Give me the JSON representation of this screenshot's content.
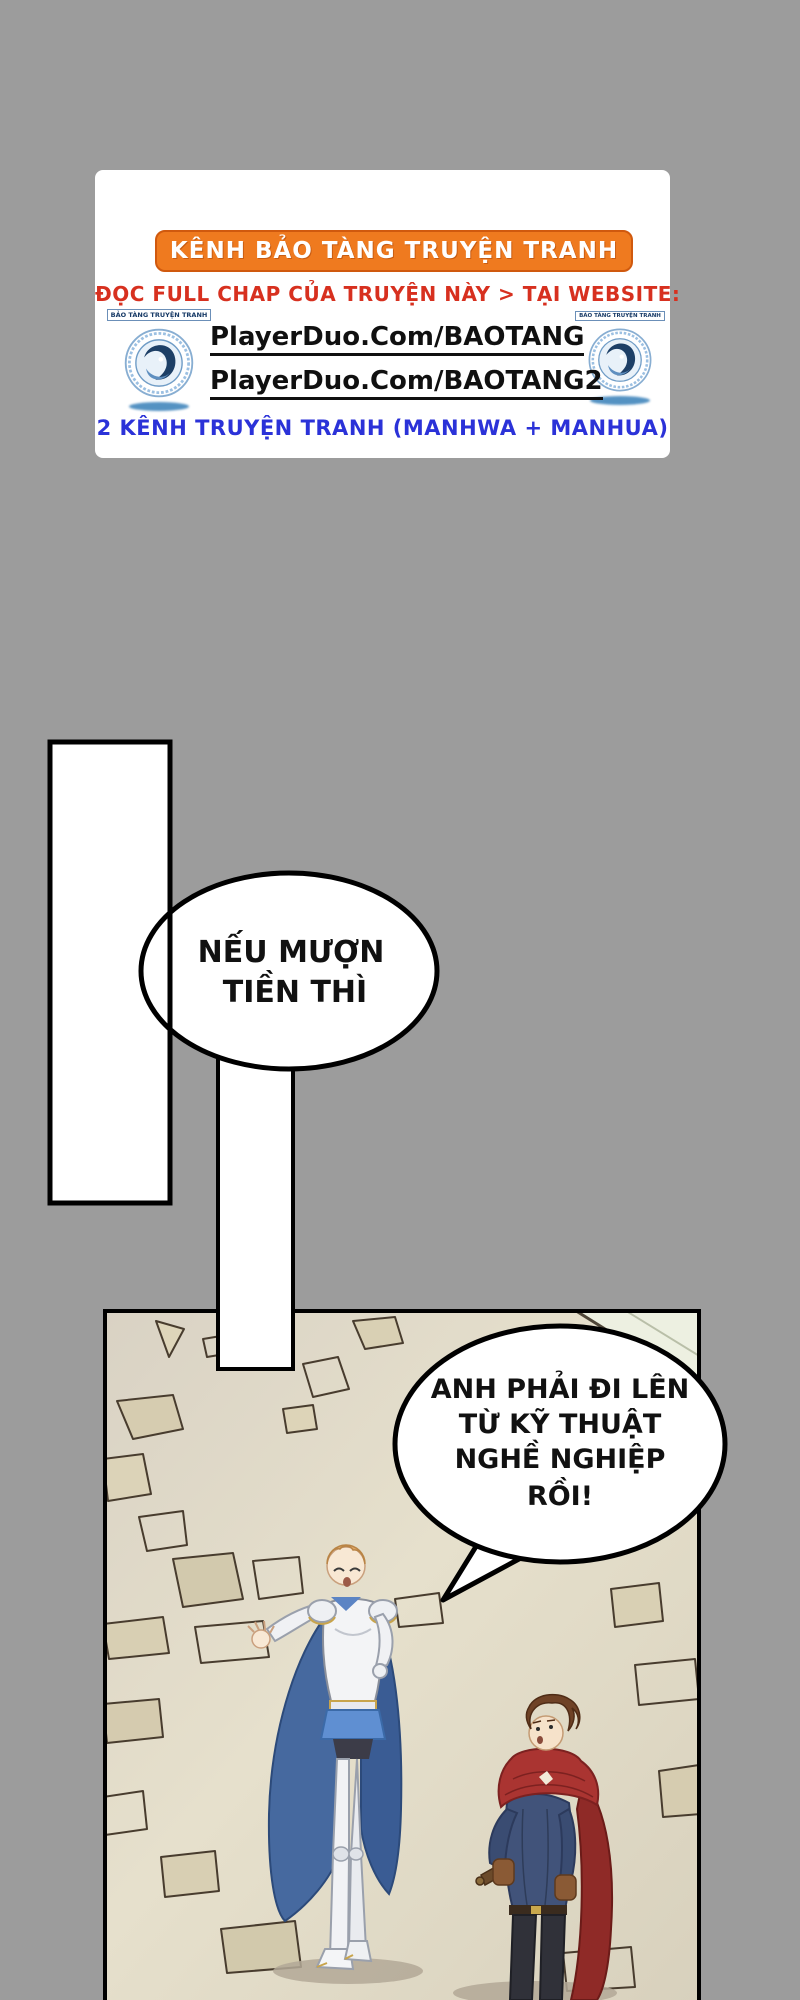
{
  "page": {
    "background_color": "#9c9c9c"
  },
  "ad": {
    "banner_label": "KÊNH BẢO TÀNG TRUYỆN TRANH",
    "banner_color": "#ef7a1f",
    "subtitle": "ĐỌC FULL CHAP CỦA TRUYỆN NÀY > TẠI WEBSITE:",
    "subtitle_color": "#d7301f",
    "links": [
      {
        "label": "PlayerDuo.Com/BAOTANG"
      },
      {
        "label": "PlayerDuo.Com/BAOTANG2"
      }
    ],
    "footer": "2 KÊNH TRUYỆN TRANH (MANHWA + MANHUA)",
    "footer_color": "#2b32d8",
    "logo_ribbon": "BẢO TÀNG TRUYỆN TRANH",
    "logo_icon": "baotang-dragon-logo"
  },
  "bubbles": {
    "bubble1": {
      "line1": "NẾU MƯỢN",
      "line2": "TIỀN THÌ"
    },
    "bubble2": {
      "line1": "ANH PHẢI ĐI LÊN",
      "line2": "TỪ KỸ THUẬT",
      "line3": "NGHỀ NGHIỆP",
      "line4": "RỒI!"
    }
  },
  "scene": {
    "characters": [
      "knight-in-white-armor-blue-cape",
      "man-in-red-cloak"
    ],
    "floor": "cracked-stone-floor",
    "palette": {
      "panel_floor": "#e4decb",
      "knight_cape_blue": "#46699f",
      "knight_tasset_blue": "#5f8fd2",
      "cloak_red": "#aa3431",
      "tunic_navy": "#41537a",
      "armor_white": "#f3f4f6",
      "gold_trim": "#c8a44c"
    }
  }
}
